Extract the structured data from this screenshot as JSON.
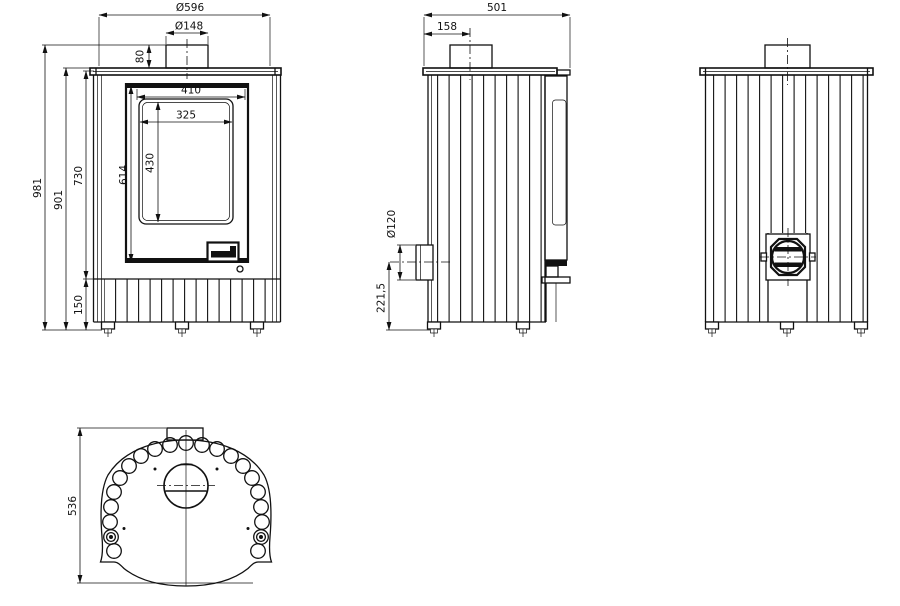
{
  "drawing": {
    "background": "#ffffff",
    "line_color": "#111111",
    "subject": "wood stove dimensional drawing with four orthographic views",
    "views": {
      "front": {
        "name": "Front elevation",
        "dims": {
          "body_diameter": "Ø596",
          "flue_diameter": "Ø148",
          "flue_collar_height": "80",
          "overall_height": "981",
          "top_plate_height": "901",
          "upper_body_height": "730",
          "door_height": "614",
          "base_height": "150",
          "door_width": "410",
          "glass_width": "325",
          "glass_height": "430"
        }
      },
      "side": {
        "name": "Side elevation",
        "dims": {
          "overall_depth": "501",
          "flue_center_from_back": "158",
          "air_inlet_diameter": "Ø120",
          "air_inlet_center_height": "221,5"
        }
      },
      "back": {
        "name": "Back elevation"
      },
      "top": {
        "name": "Top view",
        "dims": {
          "top_plate_depth": "536"
        }
      }
    }
  }
}
